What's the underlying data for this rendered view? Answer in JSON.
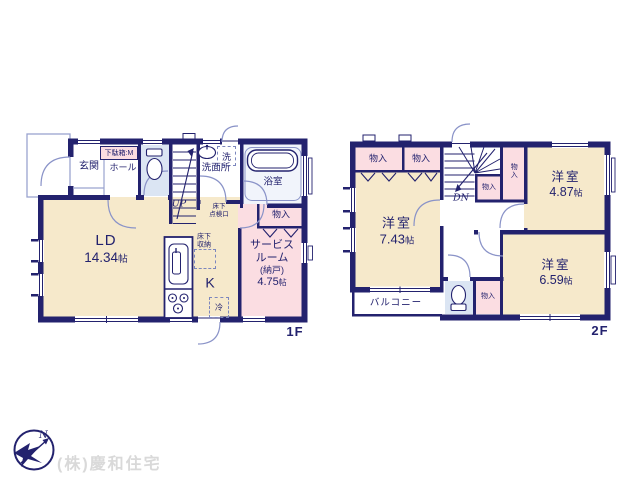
{
  "palette": {
    "wall_navy": "#23226e",
    "room_cream": "#f6e9cb",
    "room_pink": "#fbdde2",
    "room_blue": "#dbe5f3",
    "bath_blue": "#f1f4fb",
    "door_arc_blue": "#8a93c8",
    "logo_gray": "#d9d9d9"
  },
  "floor1": {
    "floor_label": "1F",
    "labels": {
      "genkan": "玄関",
      "shoe_box": "下駄箱:M",
      "hall": "ホール",
      "washroom": "洗面所",
      "washer": "洗",
      "bath": "浴室",
      "stairs_up": "UP",
      "hatch_line1": "床下",
      "hatch_line2": "点検口",
      "closet": "物入",
      "service_line1": "サービス",
      "service_line2": "ルーム",
      "service_line3": "(納戸)",
      "service_area": "4.75",
      "service_unit": "帖",
      "ld_name": "LD",
      "ld_area": "14.34",
      "ld_unit": "帖",
      "kitchen": "K",
      "floor_storage_line1": "床下",
      "floor_storage_line2": "収納",
      "fridge": "冷"
    }
  },
  "floor2": {
    "floor_label": "2F",
    "labels": {
      "closet_top_left": "物入",
      "closet_top_right": "物入",
      "closet_stairs": "物入",
      "closet_stairs_side": "物入",
      "closet_bottom": "物入",
      "stairs_dn": "DN",
      "room_743_name": "洋室",
      "room_743_area": "7.43",
      "room_743_unit": "帖",
      "room_487_name": "洋室",
      "room_487_area": "4.87",
      "room_487_unit": "帖",
      "room_659_name": "洋室",
      "room_659_area": "6.59",
      "room_659_unit": "帖",
      "balcony": "バルコニー"
    }
  },
  "footer": {
    "company": "(株)慶和住宅",
    "compass_north": "N"
  }
}
